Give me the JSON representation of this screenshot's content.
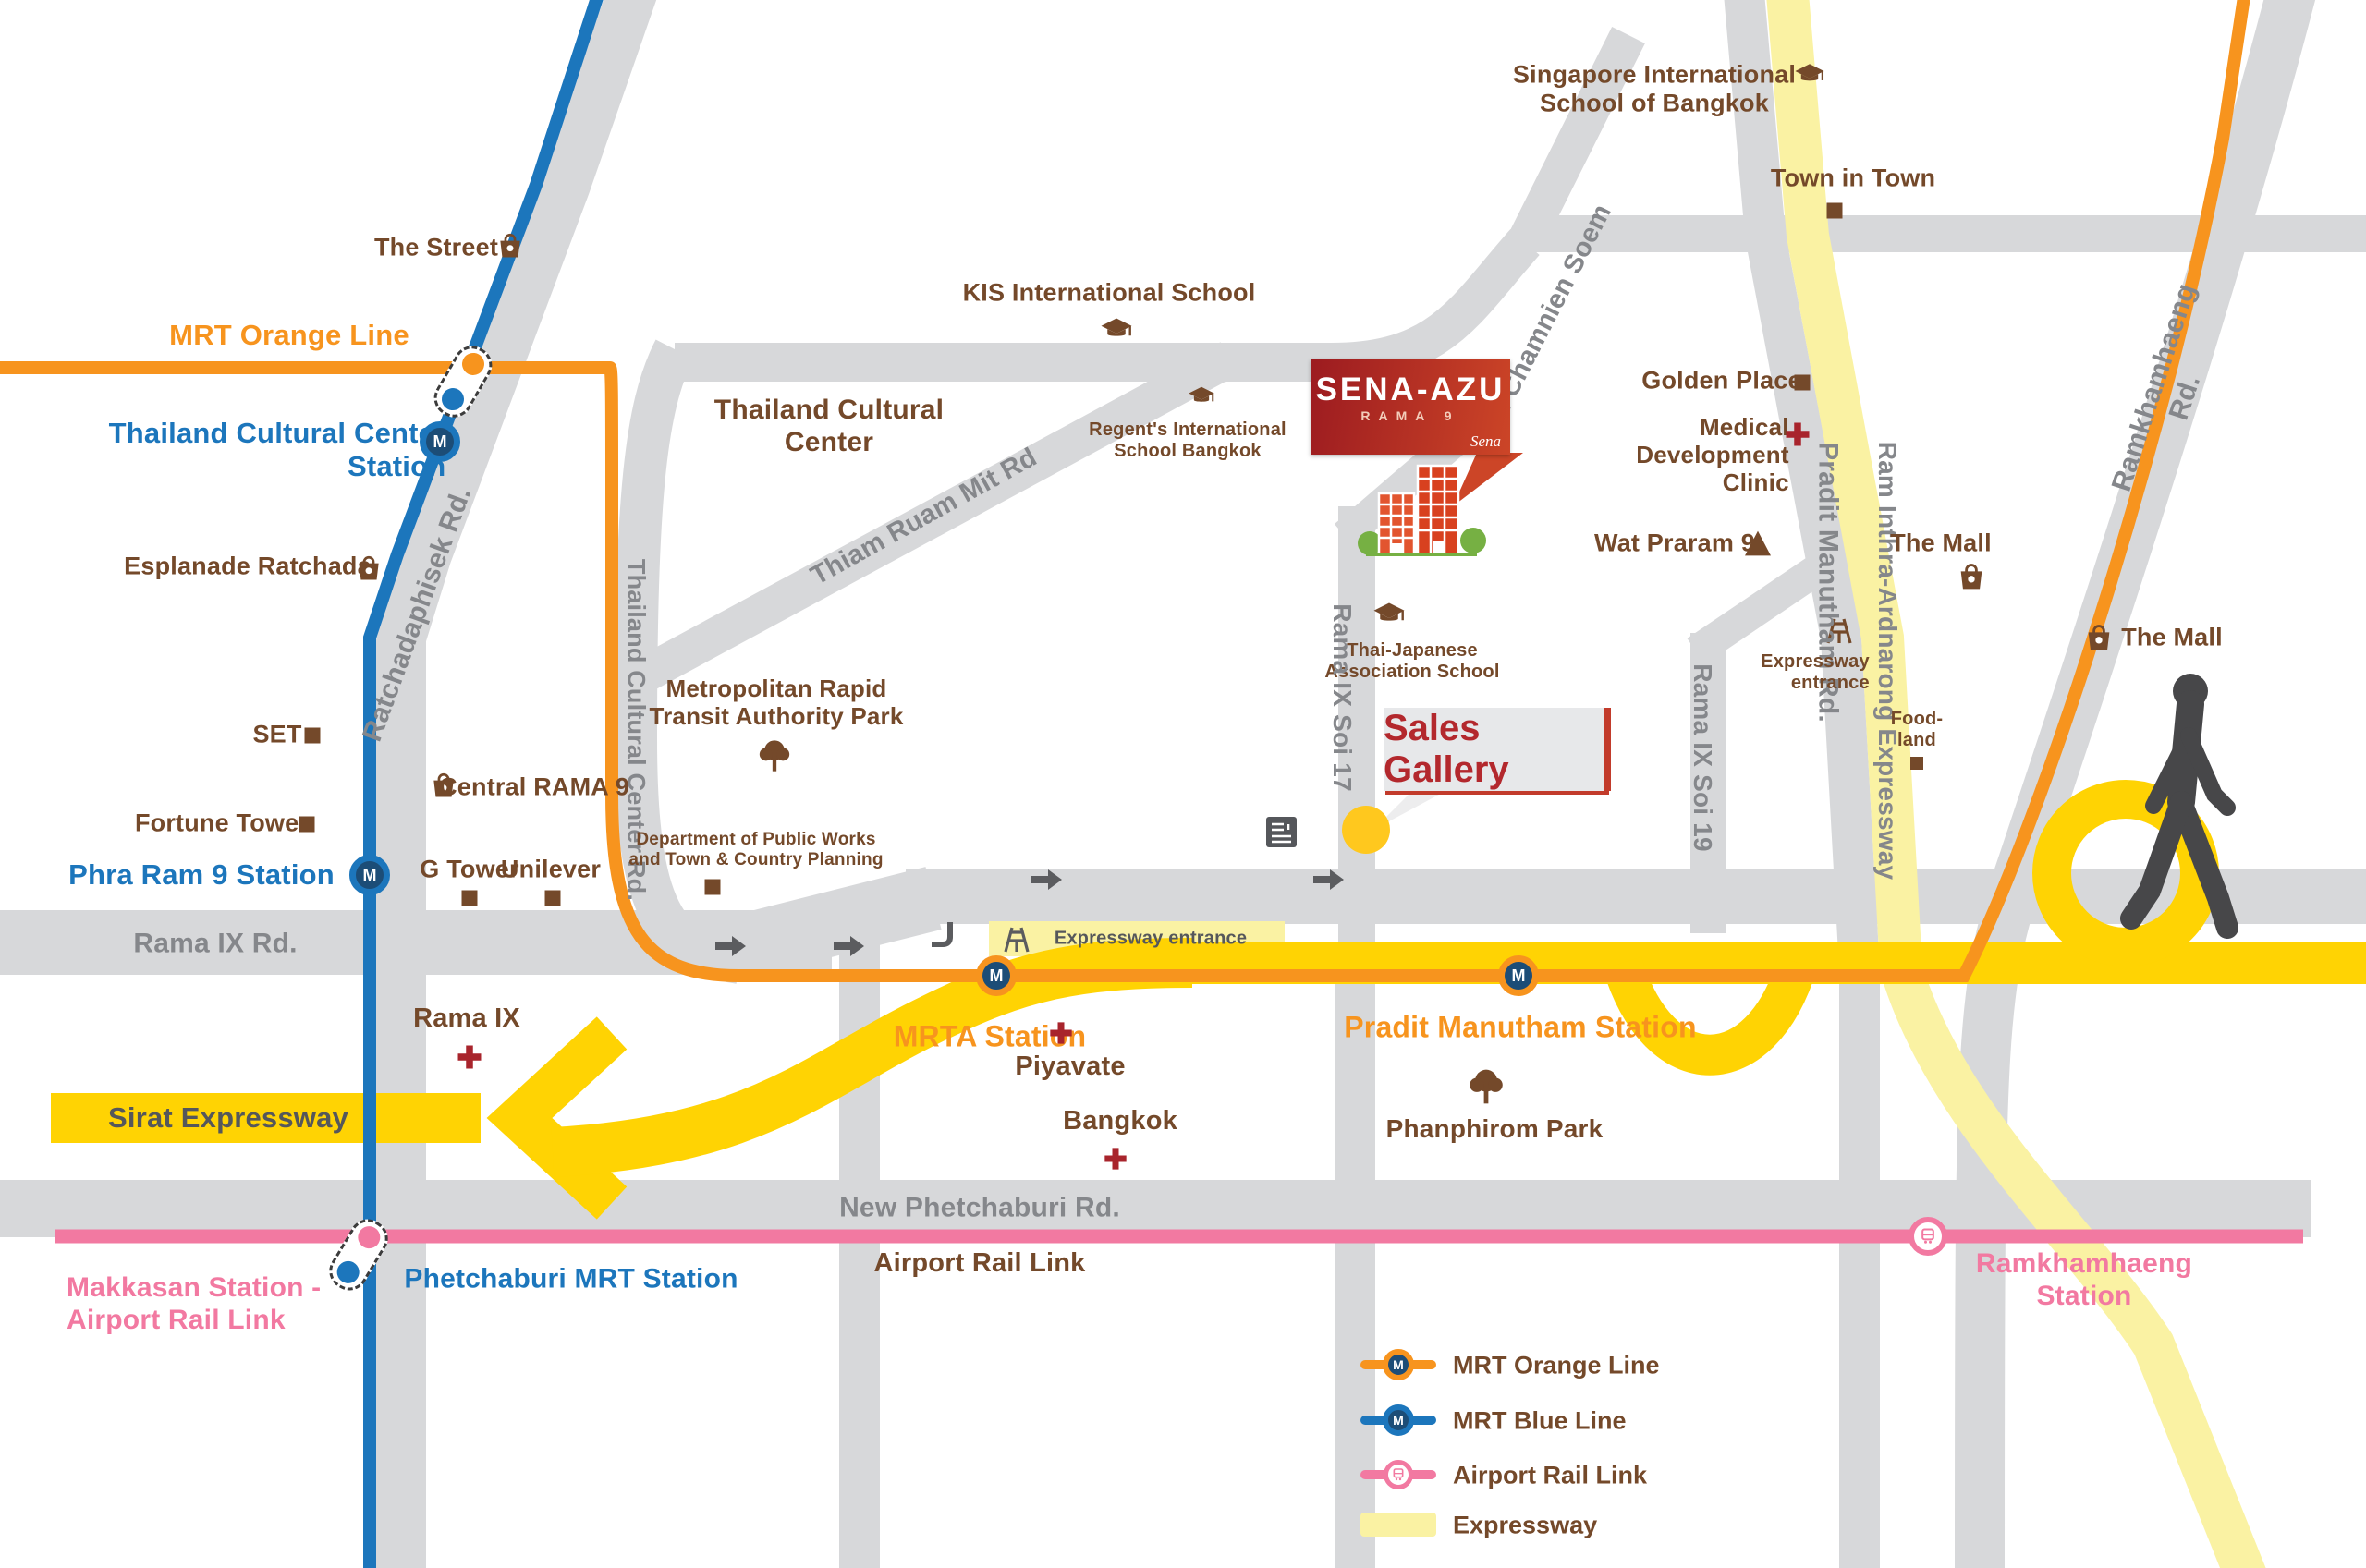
{
  "title": "SENA-AZU Rama 9 location map",
  "colors": {
    "road": "#D7D8DA",
    "roadlabel": "#85878B",
    "brown": "#74492A",
    "orange": "#F7941E",
    "blue": "#1C76BC",
    "navy": "#1C4D77",
    "pink": "#F279A1",
    "yellow": "#FFD303",
    "paleyellow": "#FAF2A3",
    "red": "#B3282D",
    "senadark": "#9C1B20",
    "senalight": "#CC4527",
    "cross": "#A8242C",
    "dkgray": "#55575B",
    "arrow": "#5B5C5F",
    "person": "#474749",
    "green": "#76B043",
    "boxgray": "#E7E8EA"
  },
  "project": {
    "name": "SENA-AZU",
    "sub": "RAMA 9",
    "brand": "Sena",
    "gallery": "Sales Gallery"
  },
  "badge": {
    "m": "M"
  },
  "labels": {
    "singapore_school": "Singapore International\nSchool of Bangkok",
    "town_in_town": "Town in Town",
    "the_street": "The Street",
    "mrt_orange_line": "MRT Orange Line",
    "tcc_station": "Thailand Cultural Center\nStation",
    "esplanade": "Esplanade Ratchada",
    "ratchadaphisek_rd": "Ratchadaphisek Rd.",
    "kis_school": "KIS International School",
    "thailand_cultural_center": "Thailand Cultural\nCenter",
    "thiam_ruam_mit_rd": "Thiam Ruam Mit Rd",
    "regents_school": "Regent's International\nSchool Bangkok",
    "soi_chamnien_soem": "Soi Chamnien Soem",
    "thai_japanese": "Thai-Japanese\nAssociation School",
    "golden_place": "Golden Place",
    "medical_clinic": "Medical\nDevelopment\nClinic",
    "pradit_manutham_rd": "Pradit Manutham Rd.",
    "ram_inthra_expwy": "Ram Inthra-Ardnarong Expressway",
    "ramkhamhaeng_rd": "Ramkhamhaeng Rd.",
    "wat_praram9": "Wat Praram 9",
    "the_mall_left": "The Mall",
    "the_mall_right": "The Mall",
    "expressway_entrance_right": "Expressway\nentrance",
    "foodland": "Food-\nland",
    "set": "SET",
    "central_rama9": "Central RAMA 9",
    "fortune_tower": "Fortune Tower",
    "phra_ram9_station": "Phra Ram 9 Station",
    "g_tower": "G Tower",
    "unilever": "Unilever",
    "tcc_rd": "Thailand Cultural Center Rd.",
    "mrta_park": "Metropolitan Rapid\nTransit Authority Park",
    "dept_public_works": "Department of Public Works\nand Town & Country Planning",
    "rama9_soi17": "Rama IX Soi 17",
    "rama9_soi19": "Rama IX Soi 19",
    "expressway_entrance_mid": "Expressway entrance",
    "mrta_station": "MRTA Station",
    "rama9_rd": "Rama IX Rd.",
    "rama9_hospital": "Rama IX",
    "sirat_expwy": "Sirat Expressway",
    "piyavate_line1": "Piyavate",
    "piyavate_line2": "Bangkok",
    "pradit_station": "Pradit Manutham Station",
    "phanphirom_park": "Phanphirom Park",
    "new_phetchaburi_rd": "New Phetchaburi Rd.",
    "airport_rail_link": "Airport Rail Link",
    "makkasan": "Makkasan Station -\nAirport Rail Link",
    "phetchaburi_station": "Phetchaburi MRT Station",
    "ramkhamhaeng_station": "Ramkhamhaeng Station"
  },
  "legend": {
    "items": [
      {
        "id": "mrt-orange-line",
        "label": "MRT Orange Line"
      },
      {
        "id": "mrt-blue-line",
        "label": "MRT Blue Line"
      },
      {
        "id": "airport-rail-link",
        "label": "Airport Rail Link"
      },
      {
        "id": "expressway",
        "label": "Expressway"
      }
    ]
  }
}
